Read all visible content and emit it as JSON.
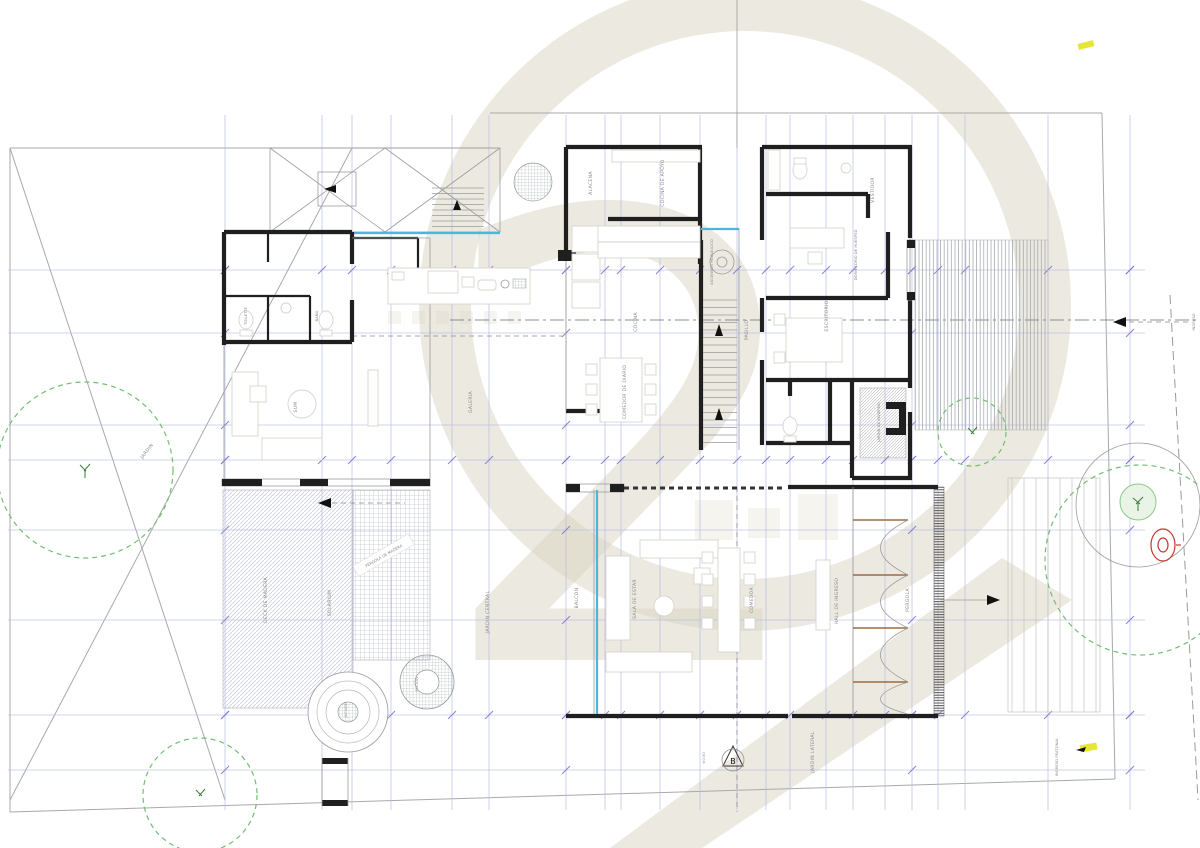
{
  "sheet": {
    "type": "architectural floor plan",
    "watermark_digit": "2",
    "colors": {
      "walls": "#1f1f1f",
      "grid": "#b7bbe3",
      "grid_tick": "#7f74cf",
      "glass": "#49b6de",
      "tree_green": "#72bf72",
      "watermark_beige": "#dad4c2",
      "marker_red": "#c0392b",
      "highlight_yellow": "#e6e63a",
      "wood_brown": "#9b6b42"
    }
  },
  "rooms": {
    "alacena": "ALACENA",
    "cocina_apoyo": "COCINA DE APOYO",
    "cocina": "COCINA",
    "pasillo": "PASILLO",
    "ascensor": "ASCENSOR HIDRAULICO",
    "comedor_diario": "COMEDOR DE DIARIO",
    "galeria": "GALERIA",
    "sum": "SUM",
    "balcon": "BALCON",
    "sala": "SALA DE ESTAR",
    "comedor": "COMEDOR",
    "hall": "HALL DE INGRESO",
    "pergola": "PERGOLA",
    "dormitorio": "DORMITORIO DE HUESPED",
    "escritorio": "ESCRITORIO",
    "vestidor": "VESTIDOR",
    "jardin_invierno": "JARDIN DE INVIERNO",
    "toilette": "TOILETTE",
    "banio": "BAÑO"
  },
  "outdoor": {
    "jardin_central": "JARDIN CENTRAL",
    "jardin_lateral": "JARDIN LATERAL",
    "jardin_delantero": "JARDIN",
    "deck": "DECK DE MADERA",
    "solarium": "SOLARIUM",
    "pergola_madera": "PERGOLA DE MADERA",
    "fogon": "FOGON",
    "jacuzzi": "JACUZZI",
    "ingreso": "INGRESO",
    "ingreso_peatonal": "INGRESO PEATONAL",
    "nivel": "±0.00",
    "benchmark": "B"
  }
}
